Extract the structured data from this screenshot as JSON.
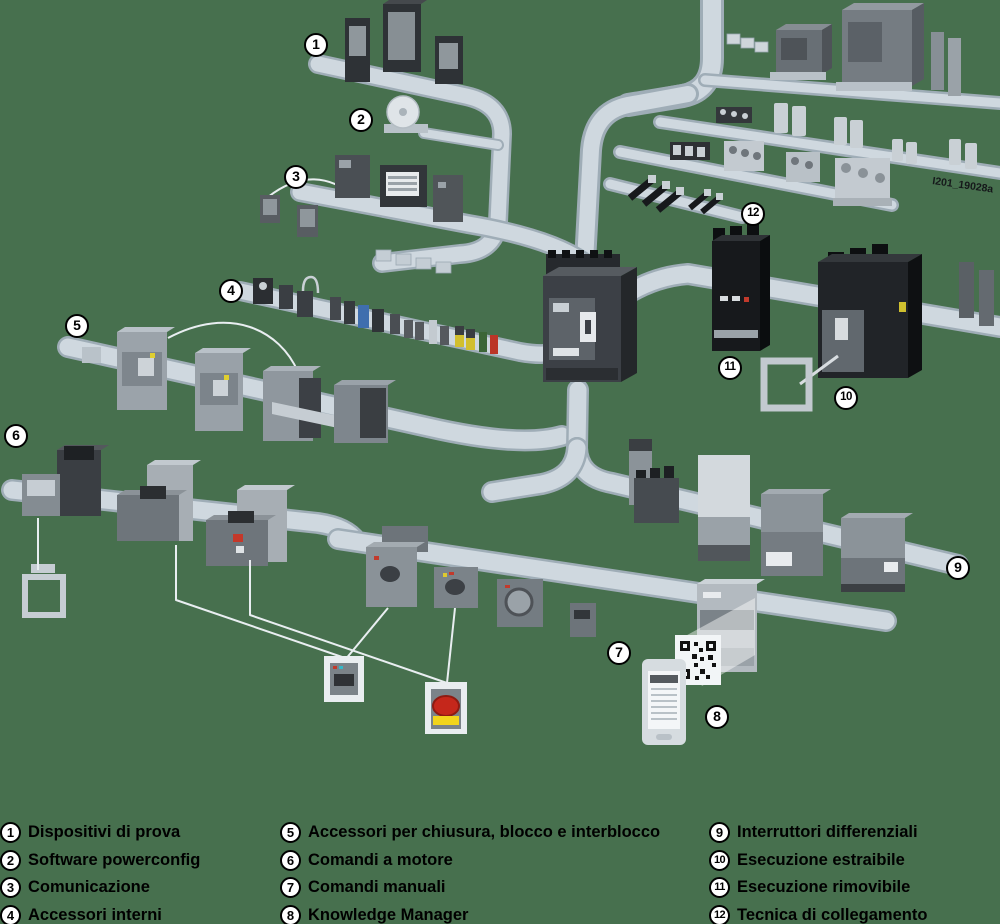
{
  "background_color": "#47704E",
  "watermark": "I201_19028a",
  "illustration": {
    "description": "Isometric system overview of molded-case circuit breakers with accessory groups connected by rails",
    "groups": [
      {
        "num": "1",
        "name": "test-devices"
      },
      {
        "num": "2",
        "name": "software-cd"
      },
      {
        "num": "3",
        "name": "communication-modules"
      },
      {
        "num": "4",
        "name": "internal-accessories"
      },
      {
        "num": "5",
        "name": "locking-interlocking-accessories"
      },
      {
        "num": "6",
        "name": "motor-operators"
      },
      {
        "num": "7",
        "name": "manual-operators"
      },
      {
        "num": "8",
        "name": "knowledge-manager-qr"
      },
      {
        "num": "9",
        "name": "residual-current-devices"
      },
      {
        "num": "10",
        "name": "draw-out-version"
      },
      {
        "num": "11",
        "name": "plug-in-version"
      },
      {
        "num": "12",
        "name": "connection-technology"
      }
    ]
  },
  "callouts": [
    {
      "num": "1",
      "x": 316,
      "y": 45
    },
    {
      "num": "2",
      "x": 361,
      "y": 120
    },
    {
      "num": "3",
      "x": 296,
      "y": 177
    },
    {
      "num": "4",
      "x": 231,
      "y": 291
    },
    {
      "num": "5",
      "x": 77,
      "y": 326
    },
    {
      "num": "6",
      "x": 16,
      "y": 436
    },
    {
      "num": "7",
      "x": 619,
      "y": 653
    },
    {
      "num": "8",
      "x": 717,
      "y": 717
    },
    {
      "num": "9",
      "x": 958,
      "y": 568
    },
    {
      "num": "10",
      "x": 846,
      "y": 398
    },
    {
      "num": "11",
      "x": 730,
      "y": 368
    },
    {
      "num": "12",
      "x": 753,
      "y": 214
    }
  ],
  "legend": {
    "columns": [
      {
        "items": [
          {
            "num": "1",
            "label": "Dispositivi di prova"
          },
          {
            "num": "2",
            "label": "Software powerconfig"
          },
          {
            "num": "3",
            "label": "Comunicazione"
          },
          {
            "num": "4",
            "label": "Accessori interni"
          }
        ]
      },
      {
        "items": [
          {
            "num": "5",
            "label": "Accessori per chiusura, blocco e interblocco"
          },
          {
            "num": "6",
            "label": "Comandi a motore"
          },
          {
            "num": "7",
            "label": "Comandi manuali"
          },
          {
            "num": "8",
            "label": "Knowledge Manager"
          }
        ]
      },
      {
        "items": [
          {
            "num": "9",
            "label": "Interruttori differenziali"
          },
          {
            "num": "10",
            "label": "Esecuzione estraibile"
          },
          {
            "num": "11",
            "label": "Esecuzione rimovibile"
          },
          {
            "num": "12",
            "label": "Tecnica di collegamento"
          }
        ]
      }
    ]
  }
}
